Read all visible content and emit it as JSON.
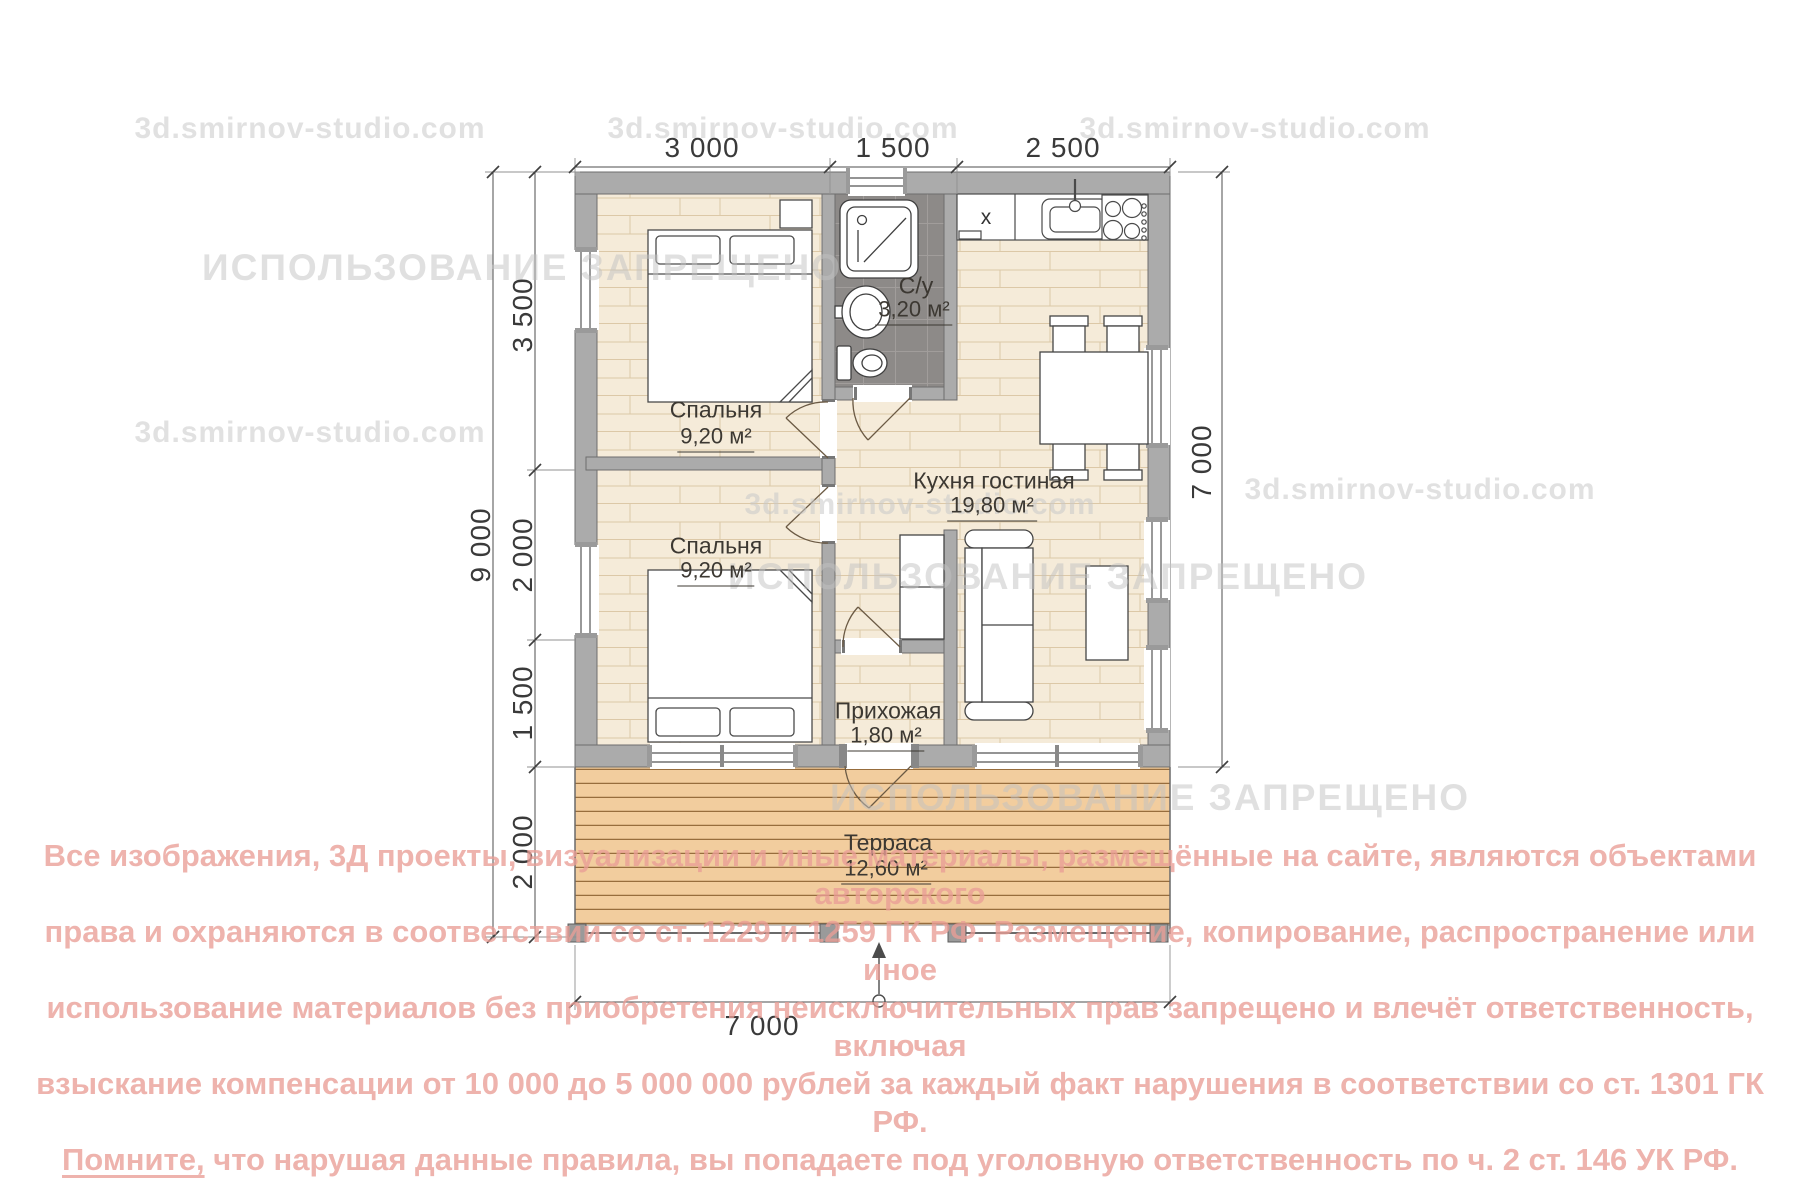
{
  "watermark": {
    "site_text": "3d.smirnov-studio.com",
    "forbidden_text": "ИСПОЛЬЗОВАНИЕ ЗАПРЕЩЕНО"
  },
  "dimensions": {
    "top_segments": [
      "3 000",
      "1 500",
      "2 500"
    ],
    "left_total": "9 000",
    "left_segments": [
      "3 500",
      "2 000",
      "1 500",
      "2 000"
    ],
    "right_total": "7 000",
    "bottom_total": "7 000"
  },
  "rooms": {
    "bedroom1": {
      "name": "Спальня",
      "area": "9,20 м²"
    },
    "bedroom2": {
      "name": "Спальня",
      "area": "9,20 м²"
    },
    "bathroom": {
      "name": "С/у",
      "area": "3,20 м²"
    },
    "kitchen_living": {
      "name": "Кухня гостиная",
      "area": "19,80 м²"
    },
    "hallway": {
      "name": "Прихожая",
      "area": "1,80 м²"
    },
    "terrace": {
      "name": "Терраса",
      "area": "12,60 м²"
    }
  },
  "fixtures": {
    "kitchen_unit_label": "x"
  },
  "copyright": {
    "line1": "Все изображения, 3Д проекты, визуализации и иные материалы, размещённые на сайте, являются объектами авторского",
    "line2": "права и охраняются в соответствии со ст. 1229 и 1259 ГК РФ. Размещение, копирование, распространение или иное",
    "line3": "использование материалов без приобретения неисключительных прав запрещено и влечёт ответственность, включая",
    "line4": "взыскание компенсации от 10 000 до 5 000 000 рублей за каждый факт нарушения в соответствии со ст. 1301 ГК РФ.",
    "line5_underlined": "Помните,",
    "line5_rest": " что нарушая данные правила, вы попадаете под уголовную ответственность по ч. 2 ст. 146 УК РФ."
  },
  "colors": {
    "wall": "#ababab",
    "floor_wood": "#f5ebd9",
    "terrace_wood": "#f2cd9e",
    "bathroom_tile": "#8d8a88",
    "copyright_text": "#e99d96",
    "watermark": "#c9c9c9"
  }
}
